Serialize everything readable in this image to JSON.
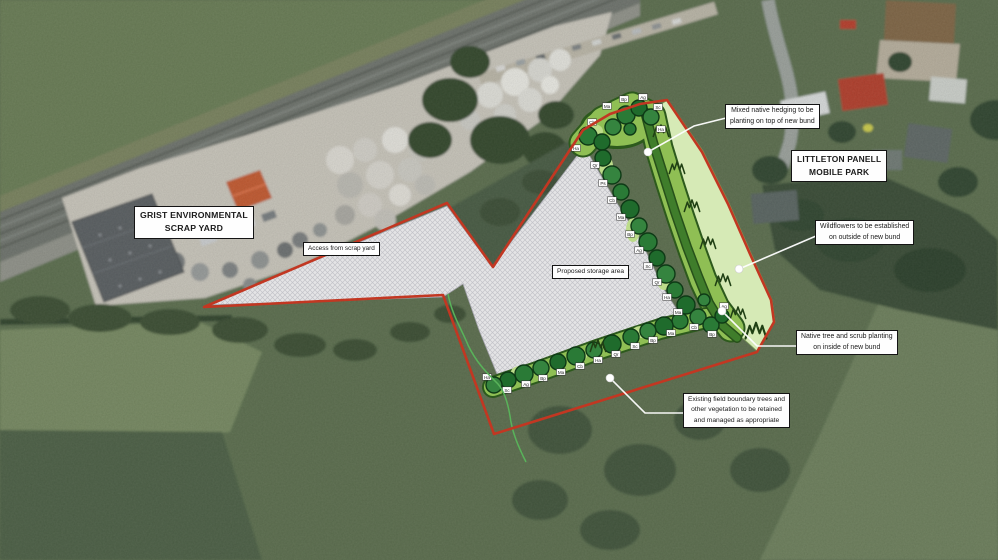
{
  "map": {
    "type": "aerial-landscape-planting-plan",
    "colors": {
      "boundary_red": "#c23722",
      "storage_hatch_grey": "#e4e4e6",
      "planting_band_green": "#8fbf54",
      "hedge_green": "#3f7d2b",
      "wildflower_green": "#d6eab6",
      "tree_dark_green": "#2a7a36",
      "leader_white": "#ffffff"
    },
    "callouts": {
      "scrap_yard": {
        "lines": [
          "GRIST ENVIRONMENTAL",
          "SCRAP YARD"
        ],
        "x": 134,
        "y": 206,
        "fs": 8.7,
        "bold": true
      },
      "mobile_park": {
        "lines": [
          "LITTLETON PANELL",
          "MOBILE PARK"
        ],
        "x": 791,
        "y": 150,
        "fs": 8.4,
        "bold": true
      },
      "access": {
        "lines": [
          "Access from scrap yard"
        ],
        "x": 303,
        "y": 242,
        "fs": 6.4,
        "bold": false
      },
      "storage": {
        "lines": [
          "Proposed storage area"
        ],
        "x": 552,
        "y": 265,
        "fs": 6.6,
        "bold": false
      },
      "hedging": {
        "lines": [
          "Mixed native hedging to be",
          "planting on top of new bund"
        ],
        "x": 725,
        "y": 104,
        "fs": 6.9,
        "bold": false
      },
      "wildflowers": {
        "lines": [
          "Wildflowers to be established",
          "on outside of new bund"
        ],
        "x": 815,
        "y": 220,
        "fs": 6.9,
        "bold": false
      },
      "native": {
        "lines": [
          "Native tree and scrub planting",
          "on inside of new bund"
        ],
        "x": 796,
        "y": 330,
        "fs": 6.9,
        "bold": false
      },
      "existing": {
        "lines": [
          "Existing field boundary trees and",
          "other vegetation to be retained",
          "and managed as appropriate"
        ],
        "x": 683,
        "y": 393,
        "fs": 6.7,
        "bold": false
      }
    },
    "planting": {
      "trees": [
        [
          588,
          136,
          9
        ],
        [
          602,
          142,
          8
        ],
        [
          613,
          127,
          8
        ],
        [
          626,
          115,
          9
        ],
        [
          639,
          108,
          8
        ],
        [
          651,
          117,
          8
        ],
        [
          630,
          129,
          6
        ],
        [
          603,
          158,
          8
        ],
        [
          612,
          175,
          9
        ],
        [
          621,
          192,
          8
        ],
        [
          630,
          209,
          9
        ],
        [
          639,
          226,
          8
        ],
        [
          648,
          242,
          9
        ],
        [
          657,
          258,
          8
        ],
        [
          666,
          274,
          9
        ],
        [
          675,
          290,
          8
        ],
        [
          686,
          305,
          9
        ],
        [
          698,
          317,
          8
        ],
        [
          711,
          325,
          8
        ],
        [
          722,
          316,
          7
        ],
        [
          704,
          300,
          6
        ],
        [
          680,
          321,
          8
        ],
        [
          664,
          326,
          9
        ],
        [
          648,
          331,
          8
        ],
        [
          631,
          337,
          8
        ],
        [
          612,
          344,
          9
        ],
        [
          594,
          350,
          8
        ],
        [
          576,
          356,
          9
        ],
        [
          558,
          362,
          8
        ],
        [
          541,
          368,
          8
        ],
        [
          524,
          374,
          9
        ],
        [
          508,
          380,
          8
        ],
        [
          494,
          385,
          8
        ]
      ],
      "species_tags": [
        [
          576,
          148,
          "Ha"
        ],
        [
          592,
          122,
          "Cb"
        ],
        [
          607,
          106,
          "Ma"
        ],
        [
          624,
          99,
          "Bp"
        ],
        [
          643,
          97,
          "Ag"
        ],
        [
          658,
          107,
          "Sc"
        ],
        [
          661,
          129,
          "Ha"
        ],
        [
          595,
          165,
          "Qr"
        ],
        [
          603,
          183,
          "Ps"
        ],
        [
          612,
          200,
          "Cb"
        ],
        [
          621,
          217,
          "Ma"
        ],
        [
          630,
          234,
          "Bp"
        ],
        [
          639,
          250,
          "Ag"
        ],
        [
          648,
          266,
          "Sc"
        ],
        [
          657,
          282,
          "Qr"
        ],
        [
          667,
          297,
          "Ha"
        ],
        [
          678,
          312,
          "Ma"
        ],
        [
          694,
          327,
          "Cb"
        ],
        [
          712,
          334,
          "Bp"
        ],
        [
          724,
          306,
          "Ag"
        ],
        [
          671,
          333,
          "Ma"
        ],
        [
          653,
          340,
          "Bp"
        ],
        [
          635,
          346,
          "Sc"
        ],
        [
          616,
          354,
          "Qr"
        ],
        [
          598,
          360,
          "Ha"
        ],
        [
          580,
          366,
          "Cb"
        ],
        [
          561,
          372,
          "Ma"
        ],
        [
          543,
          378,
          "Bp"
        ],
        [
          526,
          384,
          "Ag"
        ],
        [
          507,
          390,
          "Sc"
        ],
        [
          487,
          377,
          "Ha"
        ]
      ],
      "meadow_tufts": [
        [
          661,
          131
        ],
        [
          677,
          168
        ],
        [
          692,
          206
        ],
        [
          708,
          243
        ],
        [
          723,
          280
        ],
        [
          738,
          313
        ],
        [
          598,
          346
        ],
        [
          756,
          331,
          1.5
        ]
      ]
    }
  }
}
